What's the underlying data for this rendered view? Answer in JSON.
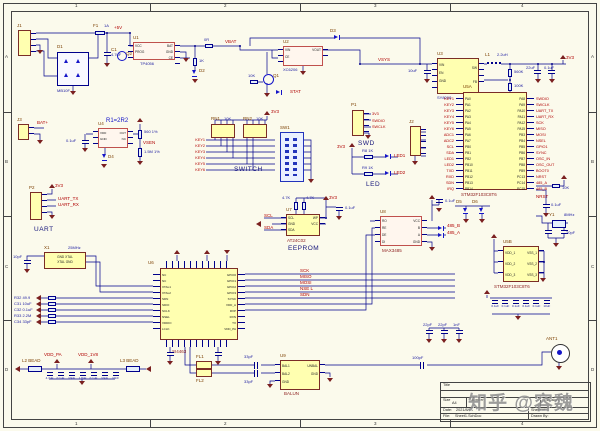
{
  "sheet": {
    "zones_top": [
      "1",
      "2",
      "3",
      "4"
    ],
    "zones_side": [
      "A",
      "B",
      "C",
      "D"
    ]
  },
  "watermark": "知乎 @容魏",
  "annotations": {
    "r1": "R1=2R2",
    "switch": "SWITCH",
    "swd": "SWD",
    "led": "LED",
    "uart": "UART",
    "eeprom": "EEPROM"
  },
  "power_entry": {
    "j1": "J1",
    "fuse_ref": "F1",
    "fuse_val": "1A",
    "net_in": "+5V",
    "bridge_ref": "D1",
    "bridge_val": "MB10F",
    "c1_ref": "C1",
    "c1_val": "4.7uF",
    "q_ref": "Q2"
  },
  "charger": {
    "ref": "U1",
    "val": "TP4056",
    "pins_l": [
      "VCC",
      "PROG"
    ],
    "pins_r": [
      "BAT",
      "GND",
      "CE"
    ],
    "net_out": "VBAT",
    "r_led": "1K",
    "d_led": "D2",
    "r0": "0R"
  },
  "ldo": {
    "ref": "U2",
    "val": "XC6206",
    "pins_l": [
      "VIN",
      "CE"
    ],
    "pins_r": [
      "VOUT"
    ],
    "net_out": "VSYS",
    "d3": "D3",
    "q1": "Q1",
    "rq": "10K",
    "stat": "STAT"
  },
  "buck": {
    "ref": "U3",
    "val": "SY8008",
    "pins_l": [
      "VIN",
      "EN",
      "GND"
    ],
    "pins_r": [
      "SW",
      "FB"
    ],
    "cin": "10uF",
    "l1_ref": "L1",
    "l1_val": "2.2uH",
    "rfb1": "560K",
    "rfb2": "100K",
    "cout1": "22uF",
    "cout2": "0.1uF",
    "net_out": "3V3"
  },
  "vref": {
    "ref": "U4",
    "pins_l": [
      "VDD",
      "GND"
    ],
    "pins_r": [
      "OUT",
      "NC"
    ],
    "c": "0.1uF",
    "r1": "560 1%",
    "r2": "1.5M 1%",
    "d4": "D4",
    "net": "VSEN"
  },
  "bat_conn": {
    "ref": "J3",
    "net": "BAT+"
  },
  "mcu": {
    "ref": "U5A",
    "val": "STM32F103C8T6",
    "j2": "J2",
    "pins_l": [
      "PA0",
      "PA1",
      "PA2",
      "PA3",
      "PA4",
      "PA5",
      "PA6",
      "PA7",
      "PB0",
      "PB1",
      "PB2",
      "PB10",
      "PB11",
      "PB12",
      "PB13",
      "PB14"
    ],
    "nets_l": [
      "KEY1",
      "KEY2",
      "KEY3",
      "KEY4",
      "KEY5",
      "KEY6",
      "ADC1",
      "ADC2",
      "SCL",
      "SDA",
      "LED1",
      "LED2",
      "TXD",
      "RXD",
      "SDN",
      "IRQ"
    ],
    "pins_r": [
      "PA8",
      "PA9",
      "PA10",
      "PA11",
      "PA12",
      "PA15",
      "PB3",
      "PB4",
      "PB5",
      "PB6",
      "PB7",
      "PB8",
      "PB9",
      "PC13",
      "PC14",
      "PC15"
    ],
    "nets_r": [
      "SWDIO",
      "SWCLK",
      "UART_TX",
      "UART_RX",
      "SCK",
      "MISO",
      "MOSI",
      "NSEL",
      "GPIO1",
      "SYNC",
      "OSC_IN",
      "OSC_OUT",
      "BOOT0",
      "NRST",
      "485_A",
      "485_B"
    ],
    "y1_ref": "Y1",
    "y1_val": "8MHz",
    "c_y": "20pF",
    "r_rst": "10K",
    "c_rst": "0.1uF",
    "net_nrst": "NRST",
    "esd1": "D5",
    "esd2": "D6"
  },
  "switch": {
    "rn1": "RN1",
    "rn2": "RN2",
    "rn_val": "10K",
    "sw": "SW1",
    "pwr": "3V3",
    "nets": [
      "KEY1",
      "KEY2",
      "KEY3",
      "KEY4",
      "KEY5",
      "KEY6"
    ]
  },
  "swd": {
    "ref": "P1",
    "nets": [
      "3V3",
      "SWDIO",
      "SWCLK"
    ]
  },
  "led": {
    "r1": "R8 1K",
    "r2": "R9 1K",
    "pwr": "3V3",
    "nets": [
      "LED1",
      "LED2"
    ]
  },
  "uart": {
    "ref": "P2",
    "pwr": "3V3",
    "nets": [
      "UART_TX",
      "UART_RX"
    ]
  },
  "eeprom": {
    "ref": "U7",
    "val": "AT24C02",
    "pins_l": [
      "SCL",
      "GND",
      "SDA"
    ],
    "pins_r": [
      "WP",
      "VCC"
    ],
    "rp1": "4.7K",
    "rp2": "4.7K",
    "c": "0.1uF",
    "pwr": "3V3",
    "nets": [
      "SCL",
      "SDA"
    ]
  },
  "xtal_mod": {
    "ref": "X1",
    "val": "25MHz",
    "row1": "GND XTAL",
    "row2": "XTAL GND",
    "c_l": "10pF"
  },
  "filters": [
    "R32 49.9",
    "C31 10uF",
    "C32 0.1uF",
    "R33 2.2M",
    "C34 33pF"
  ],
  "rf": {
    "ref": "U6",
    "val": "SI4463",
    "fl1": "FL1",
    "fl2": "FL2",
    "pins_l": [
      "NC",
      "NC",
      "XTAL1",
      "XTAL2",
      "SDN",
      "SDIO",
      "SCLK",
      "NSEL",
      "VDDIO",
      "LCLK"
    ],
    "pins_r": [
      "GPIO0",
      "GPIO1",
      "GPIO2",
      "GPIO3",
      "SYNC",
      "VDD_A",
      "RXP",
      "RXN",
      "TX",
      "VDD_PA"
    ],
    "buses": [
      "SCK",
      "MISO",
      "MOSI",
      "NSE L",
      "SDN"
    ]
  },
  "rs485": {
    "ref": "U8",
    "val": "MAX3485",
    "pins_l": [
      "RO",
      "RE",
      "DE",
      "DI"
    ],
    "pins_r": [
      "VCC",
      "B",
      "A",
      "GND"
    ],
    "c": "0.1uF",
    "nets": [
      "485_B",
      "485_A"
    ]
  },
  "mcu_pwr": {
    "ref": "U5B",
    "val": "STM32F103C8T6",
    "pins_l": [
      "VDD_1",
      "VDD_2",
      "VDD_3"
    ],
    "pins_r": [
      "VSS_1",
      "VSS_2",
      "VSS_3"
    ],
    "caps": [
      "0.1uF",
      "0.1uF",
      "0.1uF",
      "0.1uF",
      "0.1uF",
      "10uF"
    ]
  },
  "balun": {
    "ref": "U9",
    "val": "BALUN",
    "pins_l": [
      "BAL1",
      "BAL2",
      "GND"
    ],
    "pins_r": [
      "UNBAL",
      "GND"
    ],
    "c1": "33pF",
    "c2": "33pF",
    "c3": "100pF",
    "ant": "ANT1"
  },
  "beads": {
    "l2": "L2 BEAD",
    "l3": "L3 BEAD",
    "ports": [
      "VDD_PA",
      "VDD_1V8"
    ],
    "caps": [
      "4.7uF",
      "0.1uF",
      "10pF",
      "1.8pF",
      "0.1uF",
      "10pF",
      "10nF"
    ]
  },
  "bottom_caps": [
    "22pF",
    "22pF",
    "1nF"
  ],
  "title_block": {
    "title_label": "Title",
    "size_label": "Size",
    "size": "A4",
    "number_label": "Number",
    "revision_label": "Revision",
    "date_label": "Date:",
    "date": "2021/8/16",
    "file_label": "File:",
    "file": "Sheet1.SchDoc",
    "sheet_label": "Sheet of",
    "drawn_label": "Drawn By:"
  }
}
